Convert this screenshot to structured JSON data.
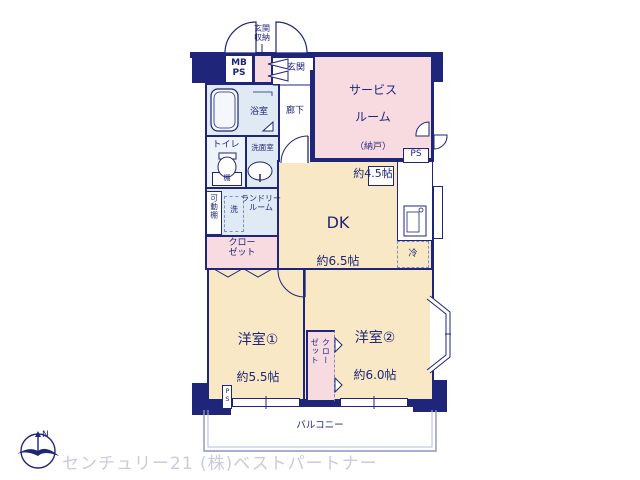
{
  "colors": {
    "wall_navy": "#1f2578",
    "room_pink": "#f8dbe0",
    "room_tan": "#f8e8c5",
    "room_lightblue": "#dfeaf4",
    "watermark_gray": "#c9cbdb"
  },
  "plan": {
    "entrance": {
      "storage_label": "玄関\n収納",
      "genkan": "玄関",
      "mbps": "MB\nPS",
      "corridor": "廊下"
    },
    "wet": {
      "bath": "浴室",
      "toilet": "トイレ",
      "shelf": "棚",
      "washroom": "洗面室",
      "movable_shelf": "可動棚",
      "washer": "洗",
      "laundry_line1": "ランドリー",
      "laundry_line2": "ルーム"
    },
    "closet_left": {
      "line1": "クロー",
      "line2": "ゼット"
    },
    "service_room": {
      "line1": "サービス",
      "line2": "ルーム",
      "line3": "（納戸）",
      "size": "約4.5帖",
      "ps": "PS"
    },
    "dk": {
      "name": "DK",
      "size": "約6.5帖",
      "fridge": "冷"
    },
    "bedroom1": {
      "name": "洋室①",
      "size": "約5.5帖"
    },
    "bedroom2": {
      "name": "洋室②",
      "size": "約6.0帖"
    },
    "closet_center": {
      "text": "クロー\nゼット"
    },
    "balcony": {
      "name": "バルコニー"
    },
    "ps_pillar": "PS",
    "compass": {
      "letter": "N"
    }
  },
  "watermark": "センチュリー21 (株)ベストパートナー"
}
